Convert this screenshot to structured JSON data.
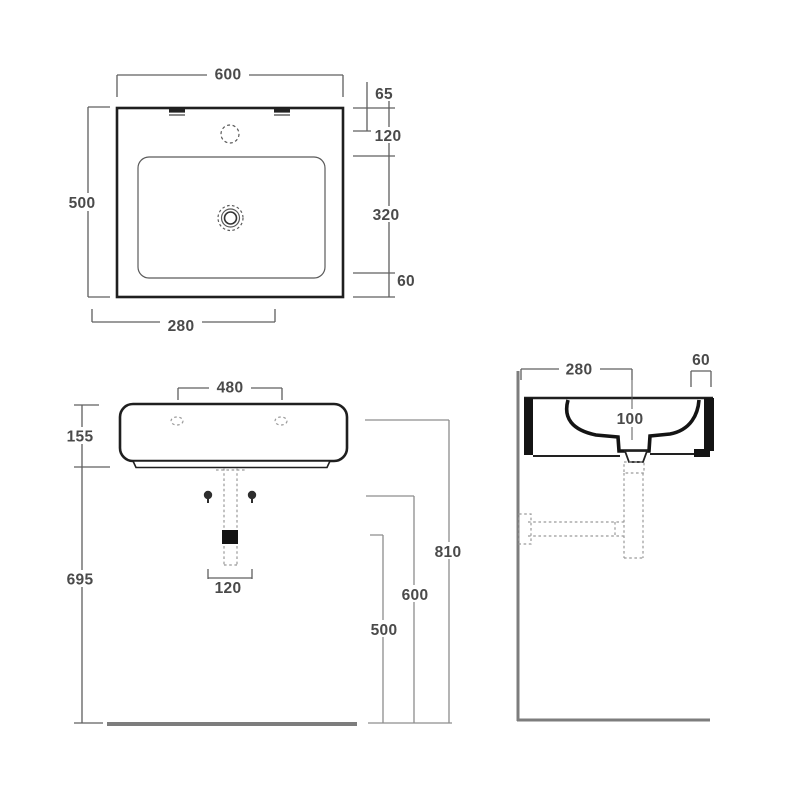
{
  "top_view": {
    "label": "top view",
    "overall_width": "600",
    "overall_depth": "500",
    "drain_offset": "280",
    "chain": [
      "65",
      "120",
      "320",
      "60"
    ]
  },
  "front_view": {
    "label": "front view",
    "tap_hole_spacing": "480",
    "body_height": "155",
    "underside_clearance": "695",
    "trap_width": "120",
    "height_rim": "810",
    "height_mid": "600",
    "height_trap": "500"
  },
  "side_view": {
    "label": "side view",
    "wall_to_drain": "280",
    "front_overhang": "60",
    "bowl_depth": "100"
  }
}
